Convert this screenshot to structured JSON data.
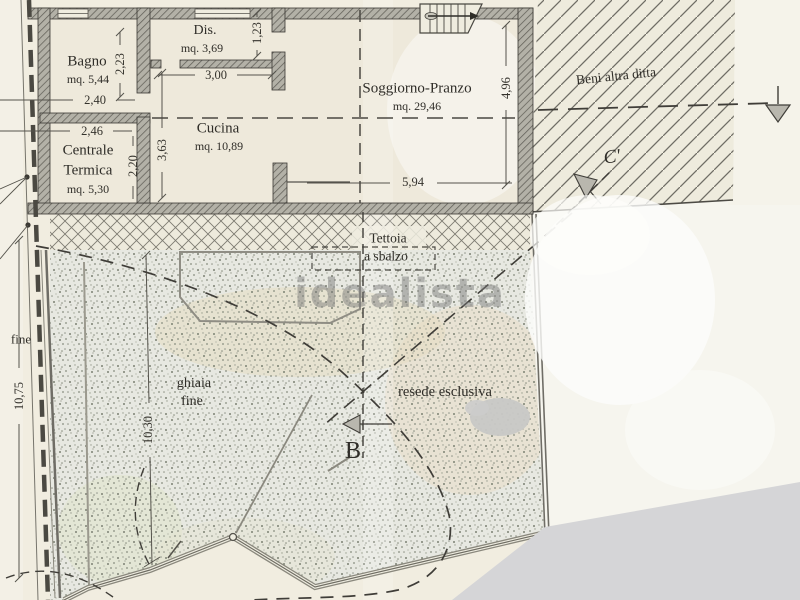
{
  "watermark": {
    "text": "idealista"
  },
  "rooms": [
    {
      "name": "Bagno",
      "area": "mq. 5,44"
    },
    {
      "name": "Dis.",
      "area": "mq. 3,69"
    },
    {
      "name": "Cucina",
      "area": "mq. 10,89"
    },
    {
      "name_line1": "Centrale",
      "name_line2": "Termica",
      "area": "mq. 5,30"
    },
    {
      "name": "Soggiorno-Pranzo",
      "area": "mq. 29,46"
    }
  ],
  "outdoor": {
    "tettoia_line1": "Tettoia",
    "tettoia_line2": "a sbalzo",
    "ghiaia_line1": "ghiaia",
    "ghiaia_line2": "fine",
    "resede": "resede esclusiva",
    "beni_altra_ditta": "Beni altra ditta",
    "boundary_partial": "fine"
  },
  "sections": {
    "b_label": "B",
    "c_label": "C'"
  },
  "dims": {
    "bagno_w": "2,40",
    "bagno_h": "2,23",
    "dis_h": "1,23",
    "cucina_w": "3,00",
    "cucina_h": "3,63",
    "centrale_w": "2,46",
    "centrale_h": "2,20",
    "soggiorno_w": "5,94",
    "soggiorno_h": "4,96",
    "garden_left": "10,75",
    "garden_inner": "10,30"
  },
  "colors": {
    "paper": "#f1ede0",
    "wall_gray": "#b3b1a7",
    "hatch_line": "#6f6d65",
    "gravel_base": "#e7e8e1",
    "scan_shadow": "#d5d5d7",
    "ink": "#2f2d28",
    "watermark_gray": "#7a7a7a"
  }
}
